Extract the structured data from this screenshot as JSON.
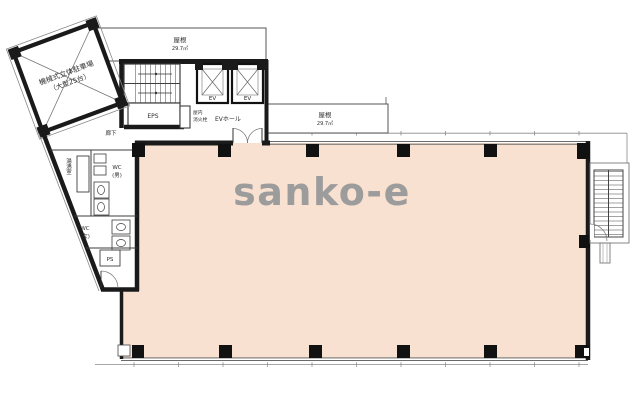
{
  "watermark": {
    "text": "sanko-e"
  },
  "colors": {
    "floor": "#f8e1d1",
    "wall": "#1a1a1a",
    "partition": "#3d3d3d",
    "light_line": "#8a8a8a",
    "watermark_gray": "#9c9c9c"
  },
  "parking": {
    "label_line1": "機械式立体駐車場",
    "label_line2": "（大型25台）"
  },
  "roof_top": {
    "label": "屋根",
    "area": "29.7㎡"
  },
  "roof_right": {
    "label": "屋根",
    "area": "29.7㎡"
  },
  "core": {
    "elevator1": "EV",
    "elevator2": "EV",
    "ev_hall": "EVホール",
    "hydrant_line1": "屋内",
    "hydrant_line2": "消火栓",
    "eps": "EPS",
    "corridor": "廊下"
  },
  "rooms": {
    "kitchenette": "湯沸室",
    "wc_men_line1": "WC",
    "wc_men_line2": "(男)",
    "wc_women_line1": "WC",
    "wc_women_line2": "(女)",
    "pipe_space": "PS"
  }
}
